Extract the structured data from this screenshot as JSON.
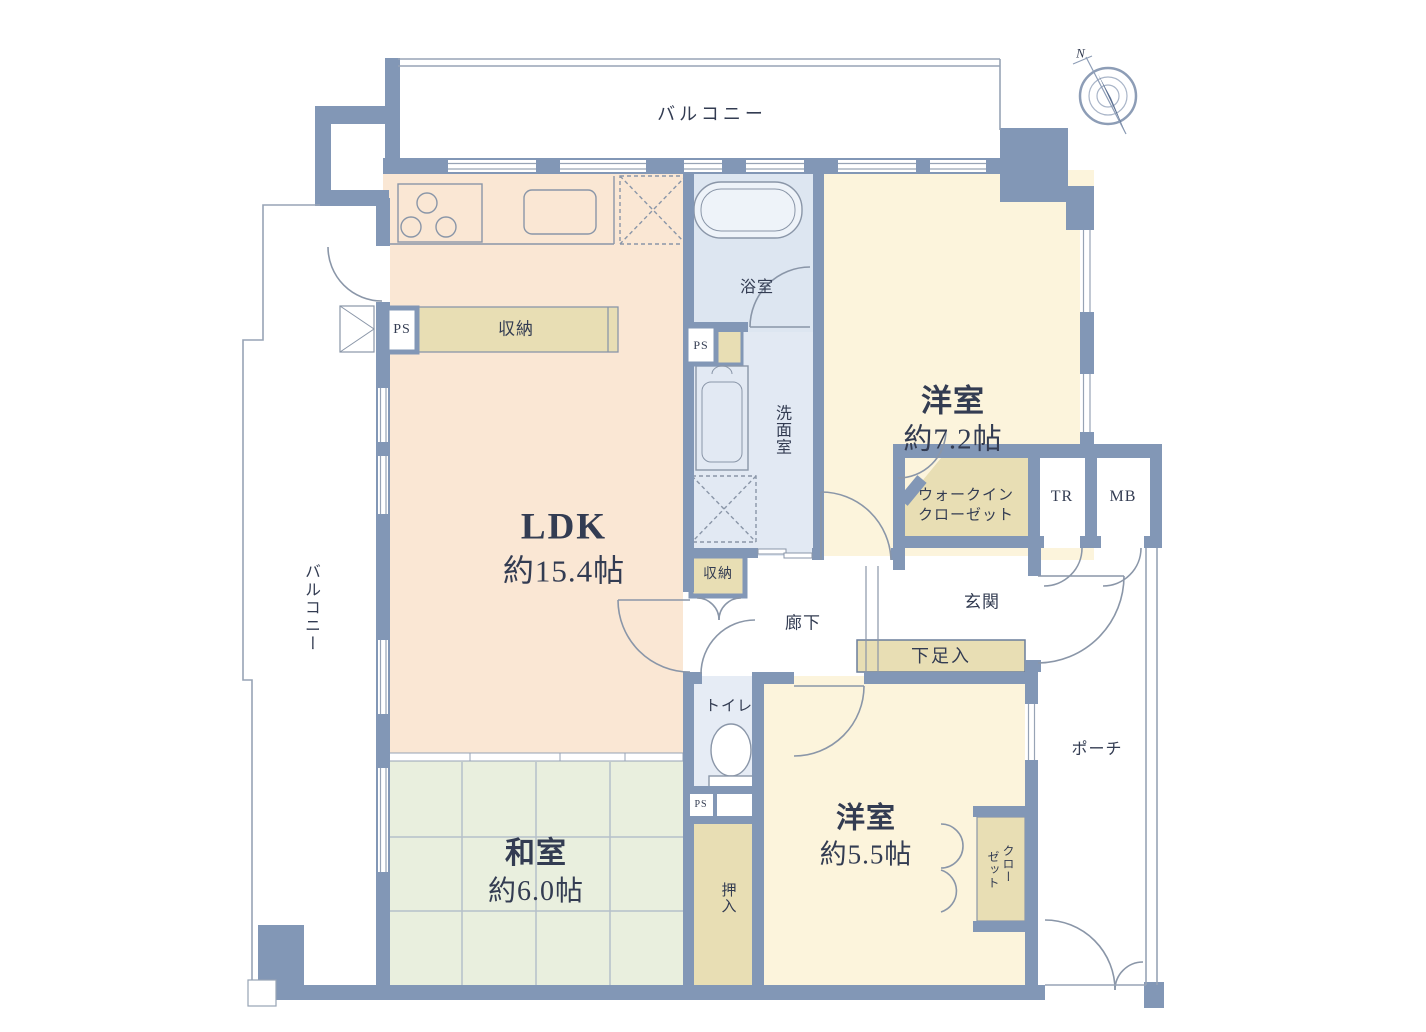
{
  "plan": {
    "balcony_top": {
      "label": "バルコニー"
    },
    "balcony_left": {
      "label": "バルコニー"
    },
    "compass": {
      "north": "N"
    },
    "rooms": {
      "ldk": {
        "name": "LDK",
        "area": "約15.4帖"
      },
      "western_7_2": {
        "name": "洋室",
        "area": "約7.2帖"
      },
      "western_5_5": {
        "name": "洋室",
        "area": "約5.5帖"
      },
      "japanese_6_0": {
        "name": "和室",
        "area": "約6.0帖"
      },
      "bath": {
        "label": "浴室"
      },
      "washroom": {
        "label": "洗面室"
      },
      "toilet": {
        "label": "トイレ"
      },
      "hallway": {
        "label": "廊下"
      },
      "entrance": {
        "label": "玄関"
      },
      "porch": {
        "label": "ポーチ"
      }
    },
    "storage": {
      "ldk_storage": {
        "label": "収納"
      },
      "hall_storage": {
        "label": "収納"
      },
      "walk_in_closet": {
        "line1": "ウォークイン",
        "line2": "クローゼット"
      },
      "closet": {
        "line1": "クロー",
        "line2": "ゼット"
      },
      "oshiire": {
        "label": "押入"
      },
      "shoe_cabinet": {
        "label": "下足入"
      }
    },
    "utilities": {
      "ps_kitchen": "PS",
      "ps_bath": "PS",
      "ps_toilet": "PS",
      "trunk": "TR",
      "meter_box": "MB"
    },
    "colors": {
      "wall": "#8297b6",
      "ldk_fill": "#fae7d4",
      "western_fill": "#fcf4dc",
      "japanese_fill": "#e9efde",
      "wet_fill": "#dfe7f2",
      "storage_fill": "#e8deb4",
      "text": "#333c52"
    }
  }
}
